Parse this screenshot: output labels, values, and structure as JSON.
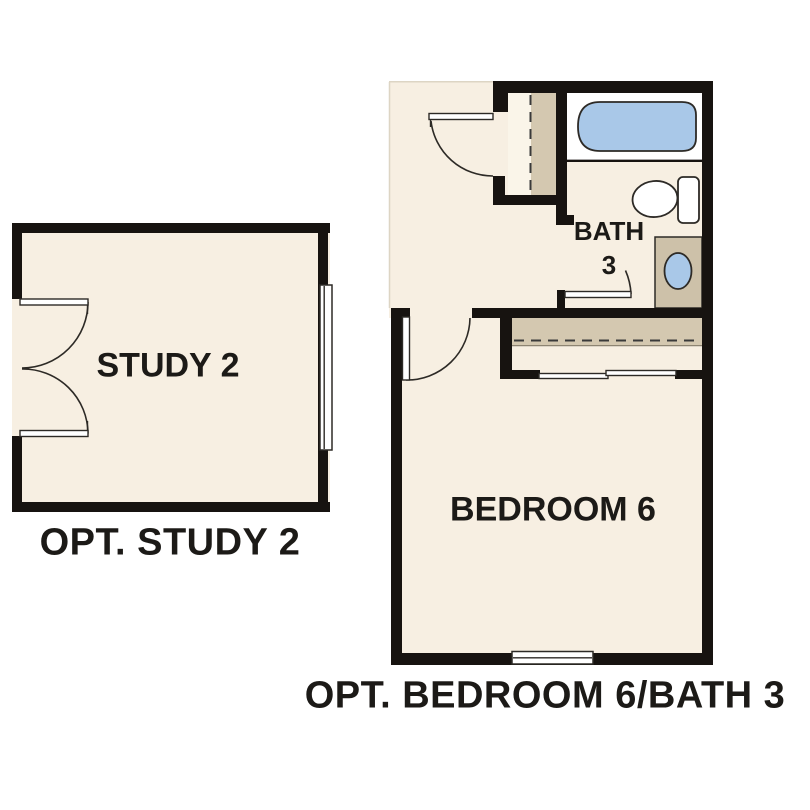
{
  "plans": {
    "study": {
      "room_label": "STUDY 2",
      "caption": "OPT. STUDY 2"
    },
    "bedroom_bath": {
      "bath_label_line1": "BATH",
      "bath_label_line2": "3",
      "bedroom_label": "BEDROOM 6",
      "caption": "OPT. BEDROOM 6/BATH 3"
    }
  },
  "fixtures": [
    "bathtub",
    "toilet",
    "vanity-sink"
  ],
  "features": [
    "double-door",
    "hinged-door",
    "bypass-closet-doors",
    "closet-rod",
    "window"
  ],
  "colors": {
    "background": "#ffffff",
    "wall": "#171310",
    "floor": "#f7efe2",
    "closet_light": "#faf5e9",
    "closet_tan": "#d4c8b0",
    "vanity_tan": "#cdc1a9",
    "fixture_blue": "#a9c8e8",
    "fixture_white": "#ffffff",
    "text": "#1c1a17"
  }
}
